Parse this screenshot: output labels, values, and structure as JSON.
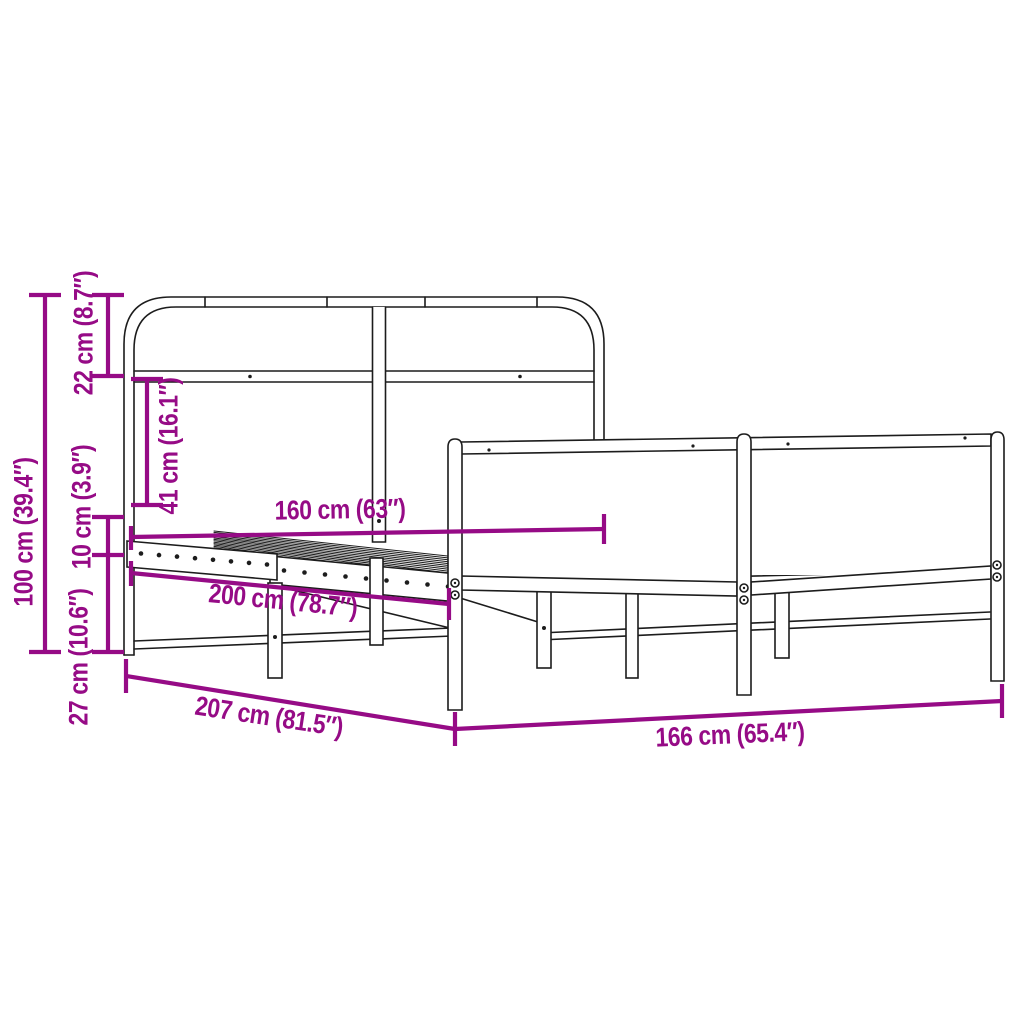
{
  "diagram": {
    "title": "Bed frame dimension diagram",
    "subject": "Metal bed frame with headboard and footboard, line drawing with measurements",
    "accent_color": "#960B86",
    "art_color": "#1c1c1c",
    "dimensions": [
      {
        "id": "total-height",
        "label": "100 cm (39.4″)",
        "cm": 100,
        "inches": 39.4,
        "orientation": "vertical"
      },
      {
        "id": "headboard-top",
        "label": "22 cm (8.7″)",
        "cm": 22,
        "inches": 8.7,
        "orientation": "vertical"
      },
      {
        "id": "headboard-middle",
        "label": "41 cm (16.1″)",
        "cm": 41,
        "inches": 16.1,
        "orientation": "vertical"
      },
      {
        "id": "side-rail-height",
        "label": "10 cm (3.9″)",
        "cm": 10,
        "inches": 3.9,
        "orientation": "vertical"
      },
      {
        "id": "under-bed-clearance",
        "label": "27 cm (10.6″)",
        "cm": 27,
        "inches": 10.6,
        "orientation": "vertical"
      },
      {
        "id": "mattress-width",
        "label": "160 cm (63″)",
        "cm": 160,
        "inches": 63,
        "orientation": "horizontal"
      },
      {
        "id": "mattress-length",
        "label": "200 cm (78.7″)",
        "cm": 200,
        "inches": 78.7,
        "orientation": "horizontal"
      },
      {
        "id": "frame-length",
        "label": "207 cm (81.5″)",
        "cm": 207,
        "inches": 81.5,
        "orientation": "horizontal"
      },
      {
        "id": "frame-width",
        "label": "166 cm (65.4″)",
        "cm": 166,
        "inches": 65.4,
        "orientation": "horizontal"
      }
    ]
  }
}
